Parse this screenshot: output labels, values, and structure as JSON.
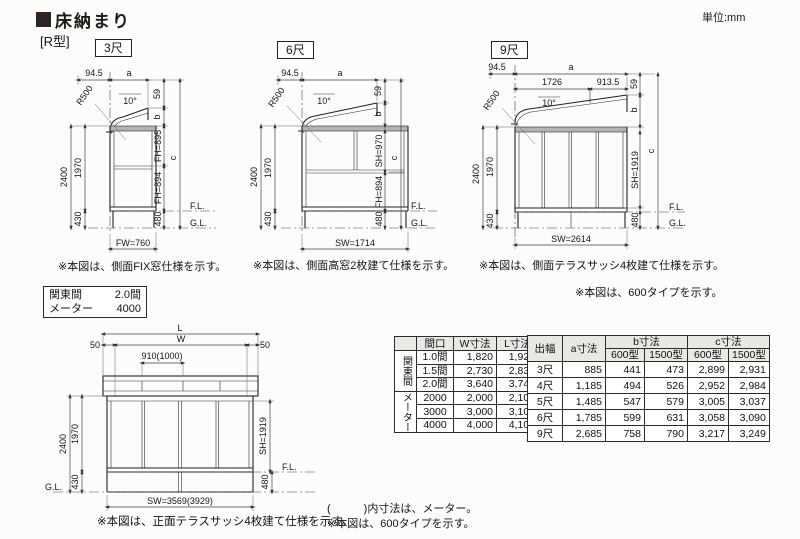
{
  "page": {
    "title": "床納まり",
    "series": "[R型]",
    "unit": "単位:mm"
  },
  "d1": {
    "tag": "3尺",
    "off": "94.5",
    "a": "a",
    "r": "R500",
    "ang": "10°",
    "n59": "59",
    "b": "b",
    "v1": "FH=895",
    "v2": "FH=894",
    "c": "c",
    "h24": "2400",
    "h19": "1970",
    "h43": "430",
    "h48": "480",
    "fl": "F.L.",
    "gl": "G.L.",
    "w": "FW=760",
    "note": "※本図は、側面FIX窓仕様を示す。"
  },
  "d2": {
    "tag": "6尺",
    "off": "94.5",
    "a": "a",
    "r": "R500",
    "ang": "10°",
    "n59": "59",
    "b": "b",
    "v1": "SH=970",
    "v2": "FH=894",
    "c": "c",
    "h24": "2400",
    "h19": "1970",
    "h43": "430",
    "h48": "480",
    "fl": "F.L.",
    "gl": "G.L.",
    "w": "SW=1714",
    "note": "※本図は、側面高窓2枚建て仕様を示す。"
  },
  "d3": {
    "tag": "9尺",
    "off": "94.5",
    "a": "a",
    "s1": "1726",
    "s2": "913.5",
    "r": "R500",
    "ang": "10°",
    "n59": "59",
    "b": "b",
    "v1": "SH=1919",
    "c": "c",
    "h24": "2400",
    "h19": "1970",
    "h43": "430",
    "h48": "480",
    "fl": "F.L.",
    "gl": "G.L.",
    "w": "SW=2614",
    "note": "※本図は、側面テラスサッシ4枚建て仕様を示す。",
    "note2": "※本図は、600タイプを示す。"
  },
  "front": {
    "L": "L",
    "W": "W",
    "s50": "50",
    "bay": "910(1000)",
    "h24": "2400",
    "h19": "1970",
    "h43": "430",
    "h48": "480",
    "sh": "SH=1919",
    "fl": "F.L.",
    "gl": "G.L.",
    "w": "SW=3569(3929)",
    "note": "※本図は、正面テラスサッシ4枚建て仕様を示す。"
  },
  "module_box": {
    "r1l": "関東間",
    "r1v": "2.0間",
    "r2l": "メーター",
    "r2v": "4000"
  },
  "spec_table": {
    "headers": [
      "間口",
      "W寸法",
      "L寸法"
    ],
    "groups": [
      {
        "label": "関東間",
        "rows": [
          [
            "1.0間",
            "1,820",
            "1,920"
          ],
          [
            "1.5間",
            "2,730",
            "2,830"
          ],
          [
            "2.0間",
            "3,640",
            "3,740"
          ]
        ]
      },
      {
        "label": "メーター",
        "rows": [
          [
            "2000",
            "2,000",
            "2,100"
          ],
          [
            "3000",
            "3,000",
            "3,100"
          ],
          [
            "4000",
            "4,000",
            "4,100"
          ]
        ]
      }
    ]
  },
  "depth_table": {
    "h_depth": "出幅",
    "h_a": "a寸法",
    "h_b": "b寸法",
    "h_c": "c寸法",
    "sub": [
      "600型",
      "1500型",
      "600型",
      "1500型"
    ],
    "rows": [
      [
        "3尺",
        "885",
        "441",
        "473",
        "2,899",
        "2,931"
      ],
      [
        "4尺",
        "1,185",
        "494",
        "526",
        "2,952",
        "2,984"
      ],
      [
        "5尺",
        "1,485",
        "547",
        "579",
        "3,005",
        "3,037"
      ],
      [
        "6尺",
        "1,785",
        "599",
        "631",
        "3,058",
        "3,090"
      ],
      [
        "9尺",
        "2,685",
        "758",
        "790",
        "3,217",
        "3,249"
      ]
    ]
  },
  "footnotes": {
    "paren": "(　　　)内寸法は、メーター。",
    "type600": "※本図は、600タイプを示す。"
  }
}
